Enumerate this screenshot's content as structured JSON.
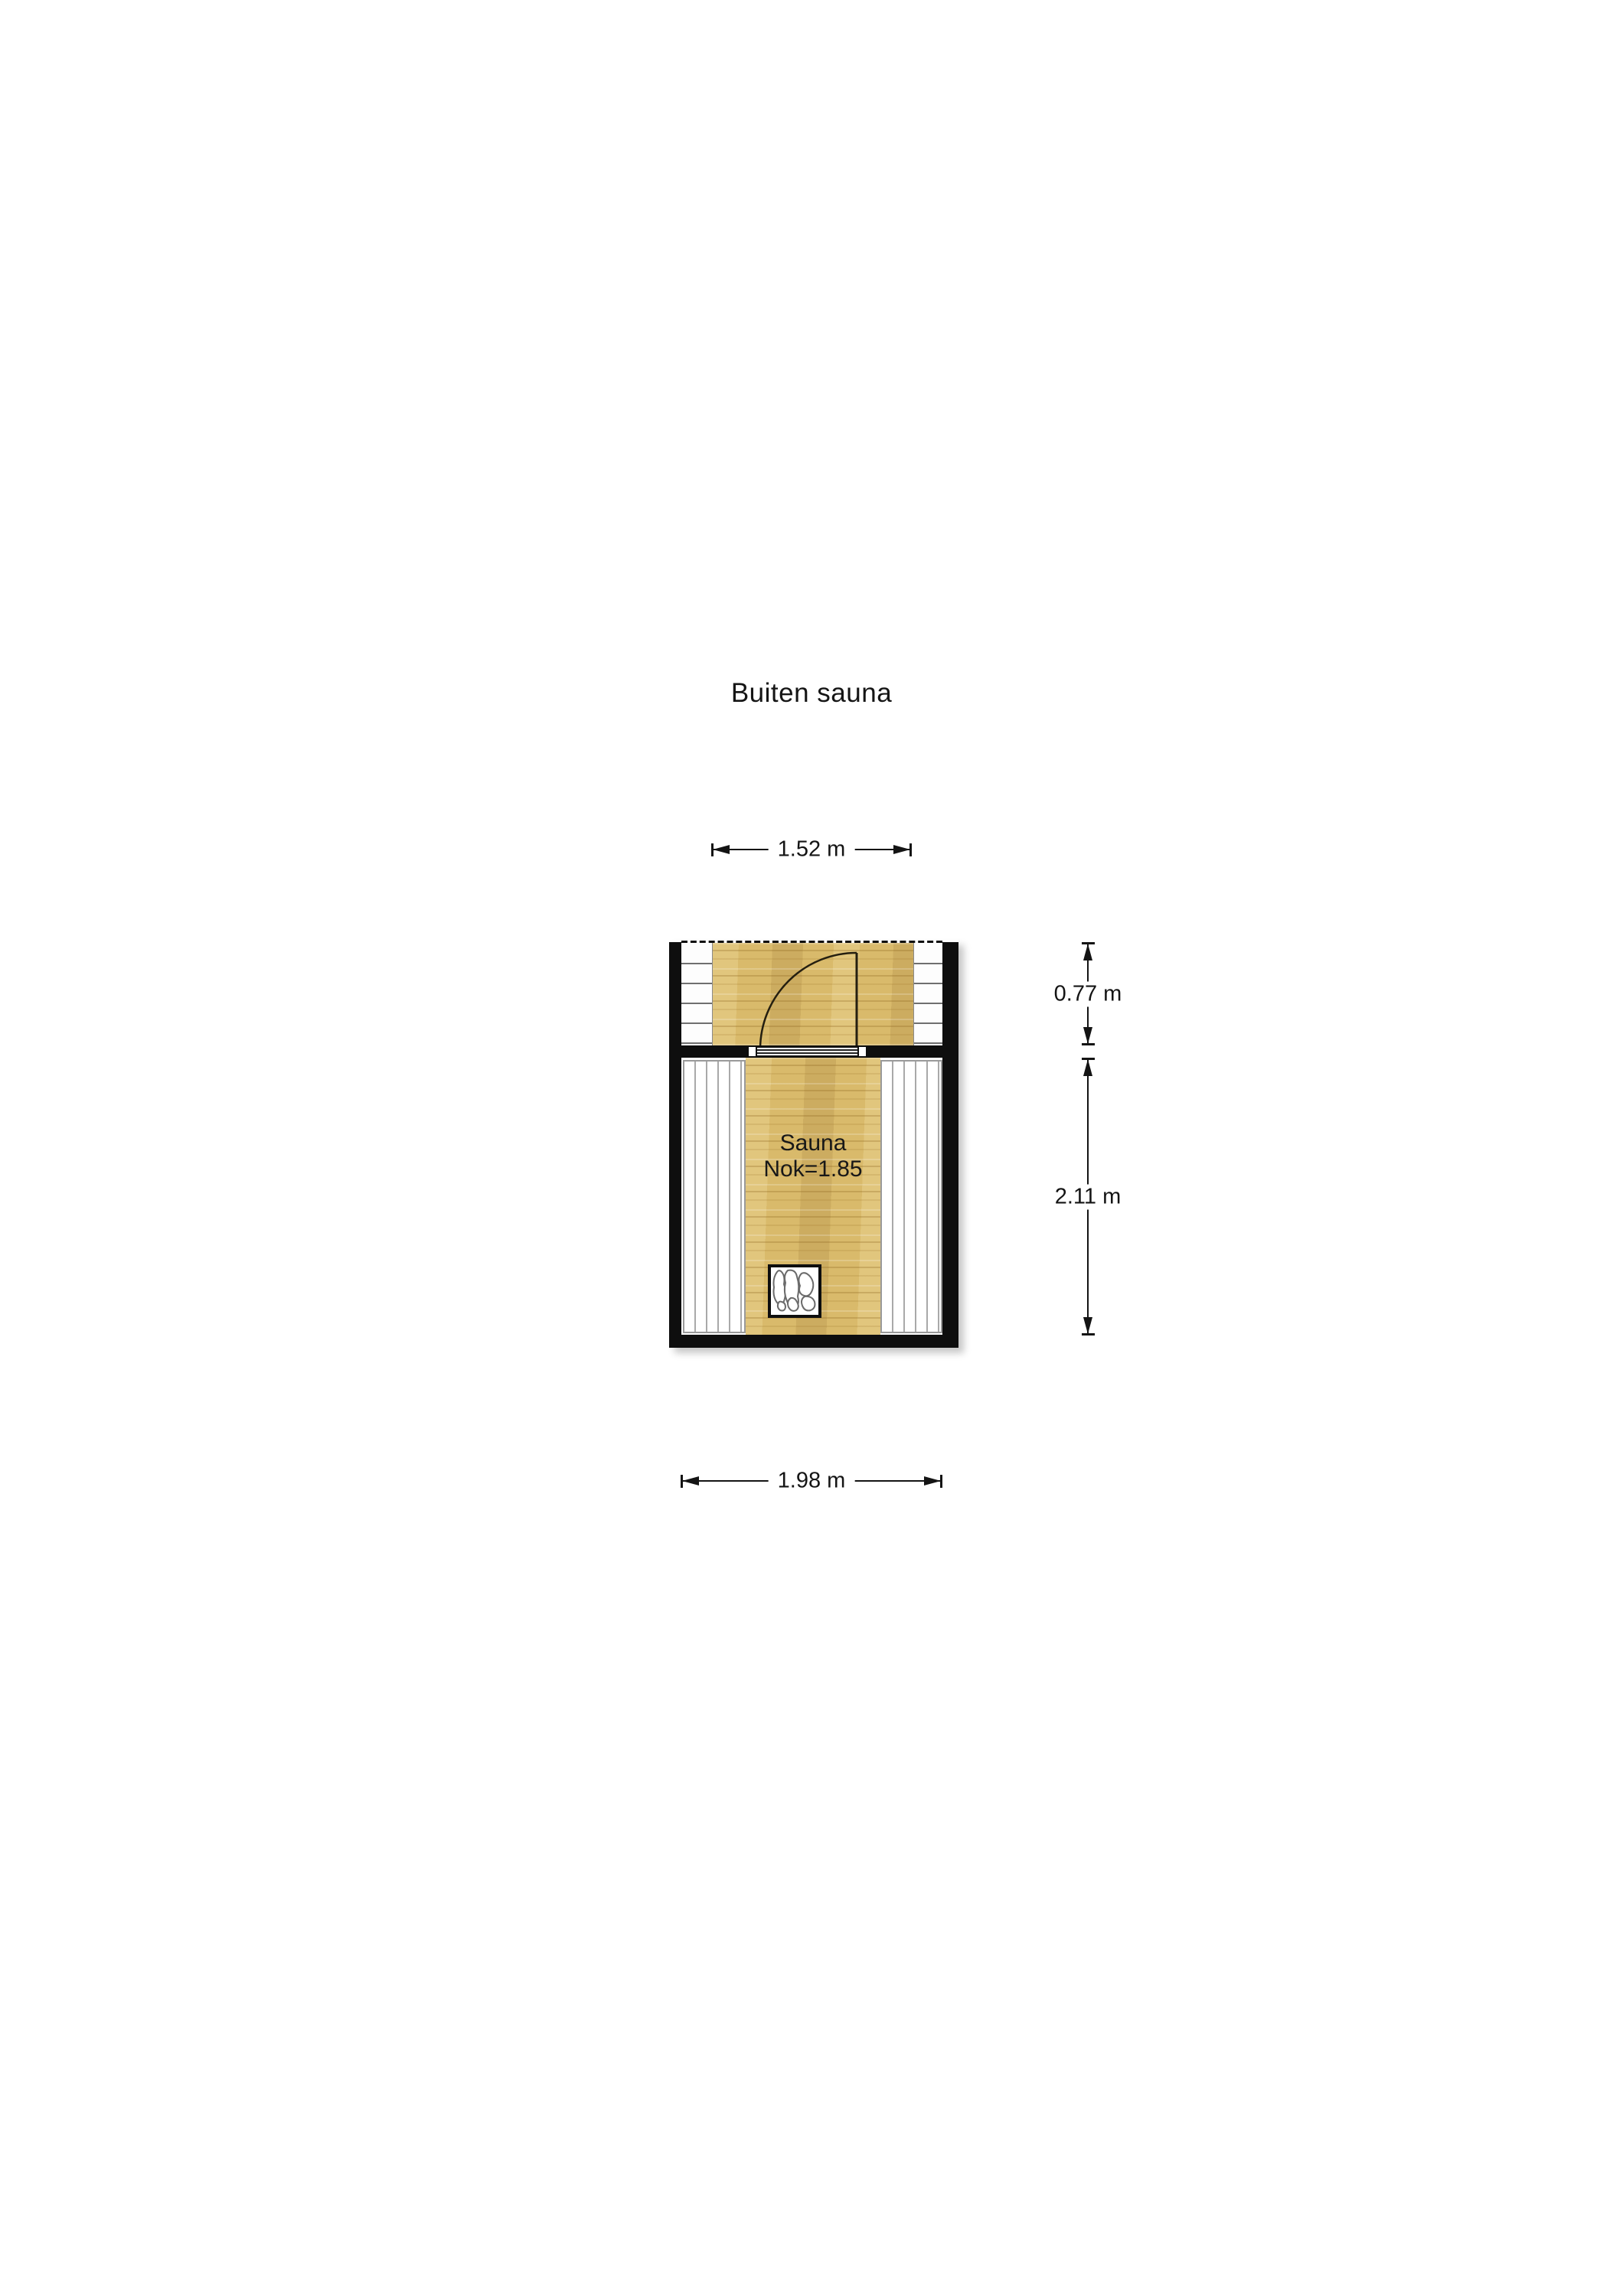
{
  "title": "Buiten sauna",
  "plan": {
    "room_label": "Sauna",
    "room_sub_label": "Nok=1.85",
    "features": [
      "door-swing",
      "door-sill",
      "left-step-strip",
      "right-step-strip",
      "left-bench",
      "right-bench",
      "heater-stones"
    ]
  },
  "dimensions": {
    "top_width": "1.52 m",
    "porch_depth": "0.77 m",
    "room_depth": "2.11 m",
    "bottom_width": "1.98 m"
  },
  "colors": {
    "background": "#ffffff",
    "wall": "#0e0e0e",
    "wood": "#d9ba6b",
    "bench_line": "#a9a9a9",
    "dimension_line": "#141414"
  }
}
